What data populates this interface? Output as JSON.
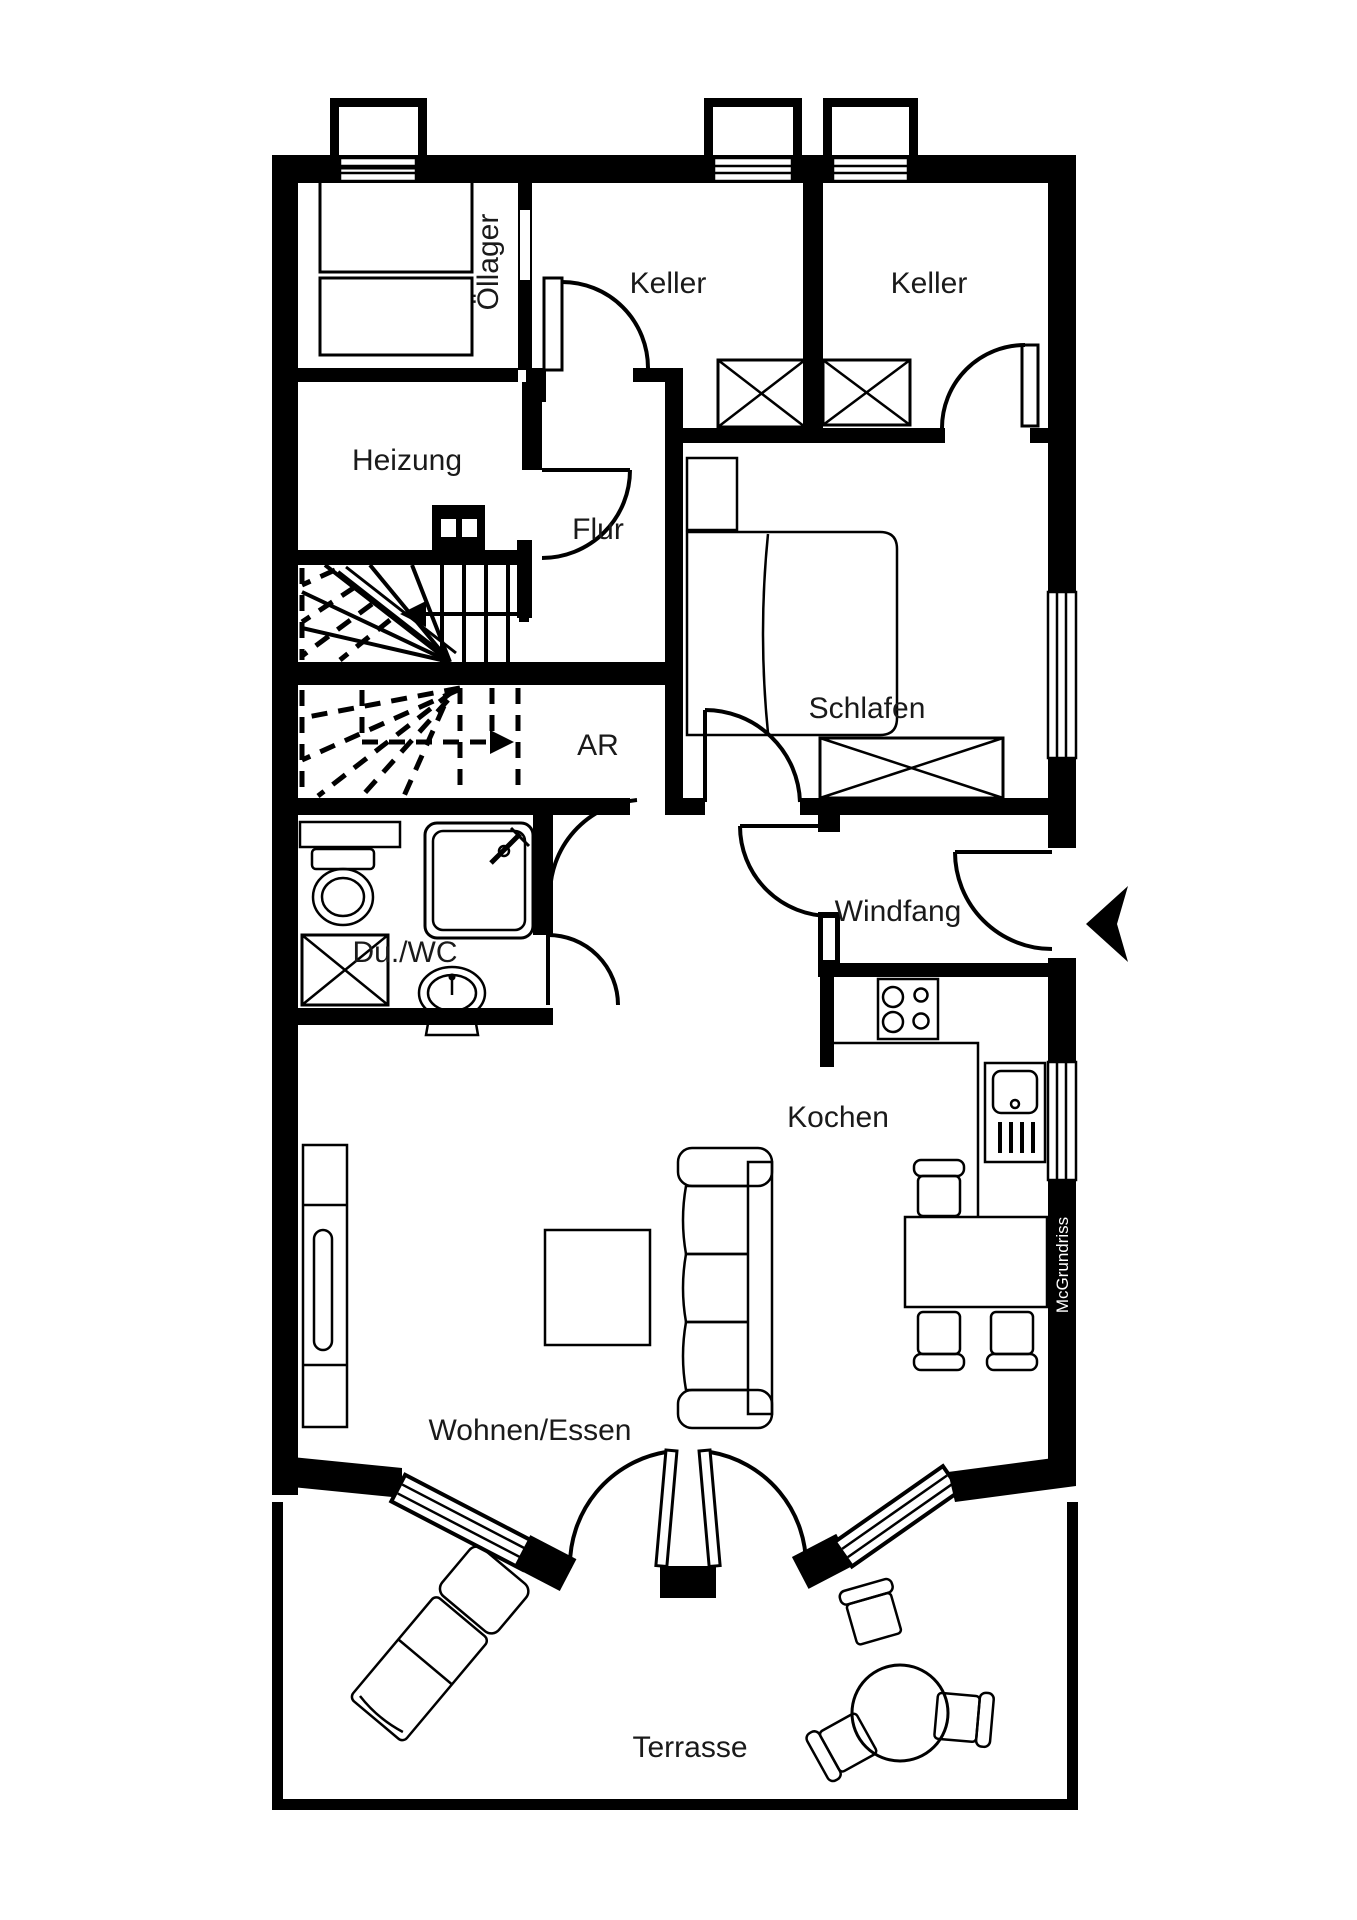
{
  "plan": {
    "type": "floor-plan",
    "floor": "basement-and-ground",
    "colors": {
      "wall": "#000000",
      "background": "#ffffff",
      "text": "#1a1a1a",
      "brand_text": "#ffffff"
    },
    "rooms": [
      {
        "label": "Öllager"
      },
      {
        "label": "Keller"
      },
      {
        "label": "Keller"
      },
      {
        "label": "Heizung"
      },
      {
        "label": "Flur"
      },
      {
        "label": "Schlafen"
      },
      {
        "label": "AR"
      },
      {
        "label": "Windfang"
      },
      {
        "label": "Du./WC"
      },
      {
        "label": "Kochen"
      },
      {
        "label": "Wohnen/Essen"
      },
      {
        "label": "Terrasse"
      }
    ],
    "watermark": {
      "label": "McGrundriss"
    },
    "symbols": [
      "oil-tanks",
      "cellar-light-wells",
      "windows",
      "stairs-up-solid",
      "stairs-down-dashed",
      "chimney",
      "bed",
      "nightstand",
      "wardrobe-crossed-box",
      "shower",
      "toilet",
      "washbasin",
      "washing-machine-crossed-box",
      "stove-hob",
      "kitchen-sink",
      "dining-table",
      "chairs",
      "sofa",
      "coffee-table",
      "sideboard",
      "french-doors",
      "sun-lounger",
      "round-terrace-table",
      "entrance-arrow"
    ]
  }
}
